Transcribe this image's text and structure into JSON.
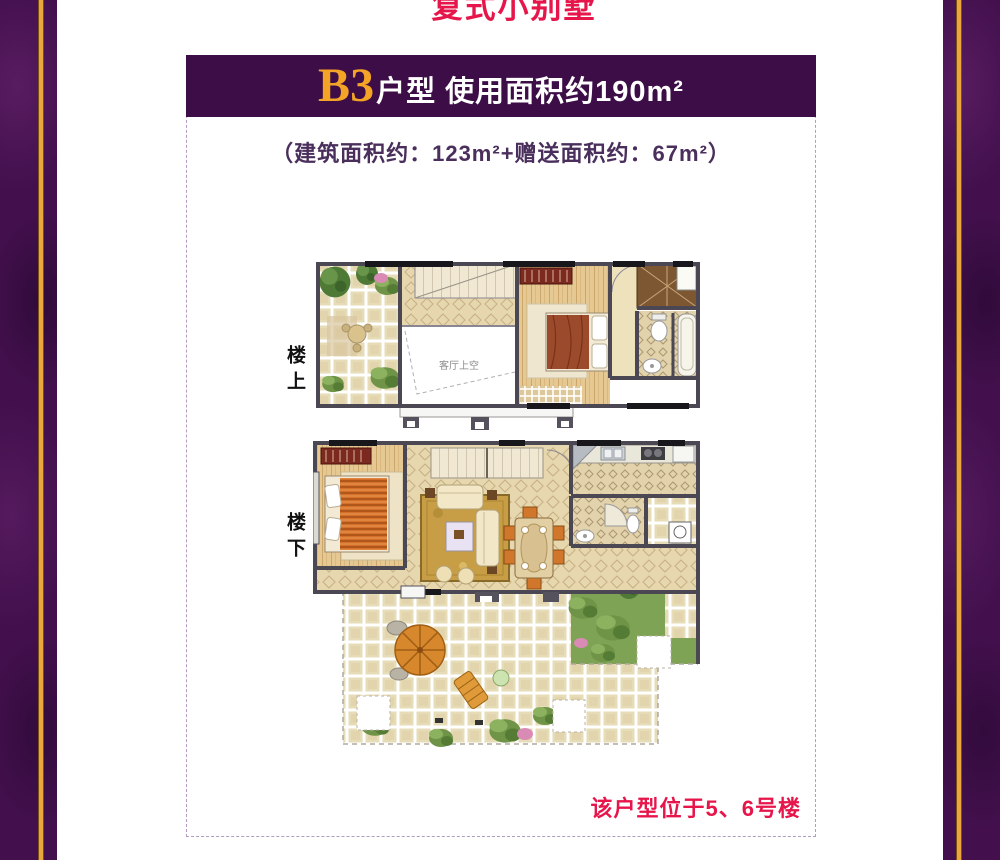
{
  "page_title": "复式小别墅",
  "header": {
    "unit": "B3",
    "title_rest": "户型  使用面积约190m²"
  },
  "subtitle": "（建筑面积约：123m²+赠送面积约：67m²）",
  "floors": {
    "upper_label": "楼上",
    "lower_label": "楼下",
    "void_label": "客厅上空"
  },
  "footer_note": "该户型位于5、6号楼",
  "colors": {
    "background_purple": "#43104d",
    "gold_stripe": "#e9a73d",
    "header_bar_purple": "#3c0d46",
    "unit_gold": "#f3a326",
    "subtitle_purple": "#4a2f5c",
    "note_red": "#e6164b",
    "wall_gray": "#4b4854",
    "floor_tan": "#e6d7ae"
  }
}
